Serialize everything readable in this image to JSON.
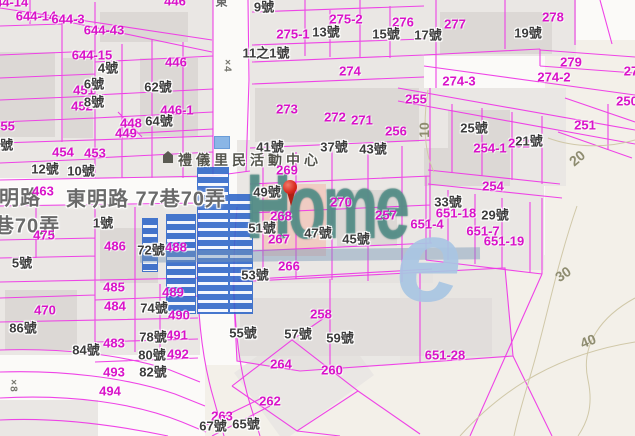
{
  "map": {
    "watermark": {
      "brand": "Home",
      "accent": "e"
    },
    "poi": {
      "t": "禮儀里民活動中心",
      "x": 250,
      "y": 160
    },
    "streets": [
      {
        "t": "東",
        "x": 222,
        "y": 1,
        "s": 12
      },
      {
        "t": "明路",
        "x": 20,
        "y": 196,
        "s": 20
      },
      {
        "t": "東明路 77巷70弄",
        "x": 146,
        "y": 197,
        "s": 20
      },
      {
        "t": "巷70弄",
        "x": 27,
        "y": 224,
        "s": 20
      }
    ],
    "marks": [
      {
        "t": "×4",
        "x": 227,
        "y": 66,
        "r": 90
      },
      {
        "t": "×8",
        "x": 13,
        "y": 386,
        "r": 90
      }
    ],
    "contours": [
      {
        "t": "10",
        "x": 424,
        "y": 130,
        "r": -90
      },
      {
        "t": "20",
        "x": 577,
        "y": 158,
        "r": -40
      },
      {
        "t": "30",
        "x": 563,
        "y": 274,
        "r": -34
      },
      {
        "t": "40",
        "x": 588,
        "y": 341,
        "r": -22
      }
    ],
    "parcels": [
      {
        "t": "644-14",
        "x": 8,
        "y": 2
      },
      {
        "t": "644-14",
        "x": 36,
        "y": 16
      },
      {
        "t": "644-3",
        "x": 68,
        "y": 19
      },
      {
        "t": "644-43",
        "x": 104,
        "y": 30
      },
      {
        "t": "644-15",
        "x": 92,
        "y": 55
      },
      {
        "t": "446",
        "x": 175,
        "y": 1
      },
      {
        "t": "446",
        "x": 176,
        "y": 62
      },
      {
        "t": "451",
        "x": 84,
        "y": 90
      },
      {
        "t": "452",
        "x": 82,
        "y": 106
      },
      {
        "t": "446-1",
        "x": 177,
        "y": 110
      },
      {
        "t": "448",
        "x": 131,
        "y": 123
      },
      {
        "t": "449",
        "x": 126,
        "y": 133
      },
      {
        "t": "455",
        "x": 4,
        "y": 126
      },
      {
        "t": "454",
        "x": 63,
        "y": 152
      },
      {
        "t": "453",
        "x": 95,
        "y": 153
      },
      {
        "t": "463",
        "x": 43,
        "y": 191
      },
      {
        "t": "475",
        "x": 44,
        "y": 235
      },
      {
        "t": "486",
        "x": 115,
        "y": 246
      },
      {
        "t": "488",
        "x": 176,
        "y": 247
      },
      {
        "t": "485",
        "x": 114,
        "y": 287
      },
      {
        "t": "489",
        "x": 173,
        "y": 292
      },
      {
        "t": "484",
        "x": 115,
        "y": 306
      },
      {
        "t": "470",
        "x": 45,
        "y": 310
      },
      {
        "t": "490",
        "x": 179,
        "y": 315
      },
      {
        "t": "491",
        "x": 177,
        "y": 335
      },
      {
        "t": "483",
        "x": 114,
        "y": 343
      },
      {
        "t": "492",
        "x": 178,
        "y": 354
      },
      {
        "t": "493",
        "x": 114,
        "y": 372
      },
      {
        "t": "494",
        "x": 110,
        "y": 391
      },
      {
        "t": "275-2",
        "x": 346,
        "y": 19
      },
      {
        "t": "276",
        "x": 403,
        "y": 22
      },
      {
        "t": "277",
        "x": 455,
        "y": 24
      },
      {
        "t": "278",
        "x": 553,
        "y": 17
      },
      {
        "t": "275-1",
        "x": 293,
        "y": 34
      },
      {
        "t": "274",
        "x": 350,
        "y": 71
      },
      {
        "t": "279",
        "x": 571,
        "y": 62
      },
      {
        "t": "274-2",
        "x": 554,
        "y": 77
      },
      {
        "t": "274-3",
        "x": 459,
        "y": 81
      },
      {
        "t": "27",
        "x": 631,
        "y": 71
      },
      {
        "t": "273",
        "x": 287,
        "y": 109
      },
      {
        "t": "272",
        "x": 335,
        "y": 117
      },
      {
        "t": "271",
        "x": 362,
        "y": 120
      },
      {
        "t": "256",
        "x": 396,
        "y": 131
      },
      {
        "t": "255",
        "x": 416,
        "y": 99
      },
      {
        "t": "250",
        "x": 627,
        "y": 101
      },
      {
        "t": "251",
        "x": 585,
        "y": 125
      },
      {
        "t": "252",
        "x": 519,
        "y": 143
      },
      {
        "t": "254-1",
        "x": 490,
        "y": 148
      },
      {
        "t": "254",
        "x": 493,
        "y": 186
      },
      {
        "t": "269",
        "x": 287,
        "y": 170
      },
      {
        "t": "270",
        "x": 341,
        "y": 202
      },
      {
        "t": "268",
        "x": 281,
        "y": 216
      },
      {
        "t": "257",
        "x": 386,
        "y": 215
      },
      {
        "t": "267",
        "x": 279,
        "y": 239
      },
      {
        "t": "266",
        "x": 289,
        "y": 266
      },
      {
        "t": "651-4",
        "x": 427,
        "y": 224
      },
      {
        "t": "651-18",
        "x": 456,
        "y": 213
      },
      {
        "t": "651-7",
        "x": 483,
        "y": 231
      },
      {
        "t": "651-19",
        "x": 504,
        "y": 241
      },
      {
        "t": "651-28",
        "x": 445,
        "y": 355
      },
      {
        "t": "258",
        "x": 321,
        "y": 314
      },
      {
        "t": "264",
        "x": 281,
        "y": 364
      },
      {
        "t": "260",
        "x": 332,
        "y": 370
      },
      {
        "t": "262",
        "x": 270,
        "y": 401
      },
      {
        "t": "263",
        "x": 222,
        "y": 416
      }
    ],
    "houses": [
      {
        "t": "9號",
        "x": 264,
        "y": 6
      },
      {
        "t": "4號",
        "x": 108,
        "y": 67
      },
      {
        "t": "6號",
        "x": 94,
        "y": 83
      },
      {
        "t": "62號",
        "x": 158,
        "y": 86
      },
      {
        "t": "8號",
        "x": 94,
        "y": 101
      },
      {
        "t": "64號",
        "x": 159,
        "y": 120
      },
      {
        "t": "4號",
        "x": 3,
        "y": 144
      },
      {
        "t": "12號",
        "x": 45,
        "y": 168
      },
      {
        "t": "10號",
        "x": 81,
        "y": 170
      },
      {
        "t": "13號",
        "x": 326,
        "y": 31
      },
      {
        "t": "15號",
        "x": 386,
        "y": 33
      },
      {
        "t": "17號",
        "x": 428,
        "y": 34
      },
      {
        "t": "19號",
        "x": 528,
        "y": 32
      },
      {
        "t": "11之1號",
        "x": 266,
        "y": 52
      },
      {
        "t": "25號",
        "x": 474,
        "y": 127
      },
      {
        "t": "21號",
        "x": 529,
        "y": 140
      },
      {
        "t": "41號",
        "x": 270,
        "y": 146
      },
      {
        "t": "37號",
        "x": 334,
        "y": 146
      },
      {
        "t": "43號",
        "x": 373,
        "y": 148
      },
      {
        "t": "49號",
        "x": 267,
        "y": 191
      },
      {
        "t": "33號",
        "x": 448,
        "y": 201
      },
      {
        "t": "29號",
        "x": 495,
        "y": 214
      },
      {
        "t": "51號",
        "x": 262,
        "y": 227
      },
      {
        "t": "47號",
        "x": 318,
        "y": 232
      },
      {
        "t": "45號",
        "x": 356,
        "y": 238
      },
      {
        "t": "53號",
        "x": 255,
        "y": 274
      },
      {
        "t": "1號",
        "x": 103,
        "y": 222
      },
      {
        "t": "5號",
        "x": 22,
        "y": 262
      },
      {
        "t": "72號",
        "x": 151,
        "y": 249
      },
      {
        "t": "86號",
        "x": 23,
        "y": 327
      },
      {
        "t": "74號",
        "x": 154,
        "y": 307
      },
      {
        "t": "78號",
        "x": 153,
        "y": 336
      },
      {
        "t": "80號",
        "x": 152,
        "y": 354
      },
      {
        "t": "84號",
        "x": 86,
        "y": 349
      },
      {
        "t": "82號",
        "x": 153,
        "y": 371
      },
      {
        "t": "55號",
        "x": 243,
        "y": 332
      },
      {
        "t": "57號",
        "x": 298,
        "y": 333
      },
      {
        "t": "59號",
        "x": 340,
        "y": 337
      },
      {
        "t": "65號",
        "x": 246,
        "y": 423
      },
      {
        "t": "67號",
        "x": 213,
        "y": 425
      }
    ],
    "colors": {
      "boundary": "#ee3ae6",
      "parcel_label": "#d912c9",
      "house_label": "#3c3c3c",
      "street_label": "#6a6a6a",
      "contour": "#8e8c70",
      "highlight_parcel": "#f0ccc3",
      "watermark_teal": "#5c9690",
      "watermark_blue": "#a9c6e3",
      "pin": "#d8281c"
    }
  }
}
